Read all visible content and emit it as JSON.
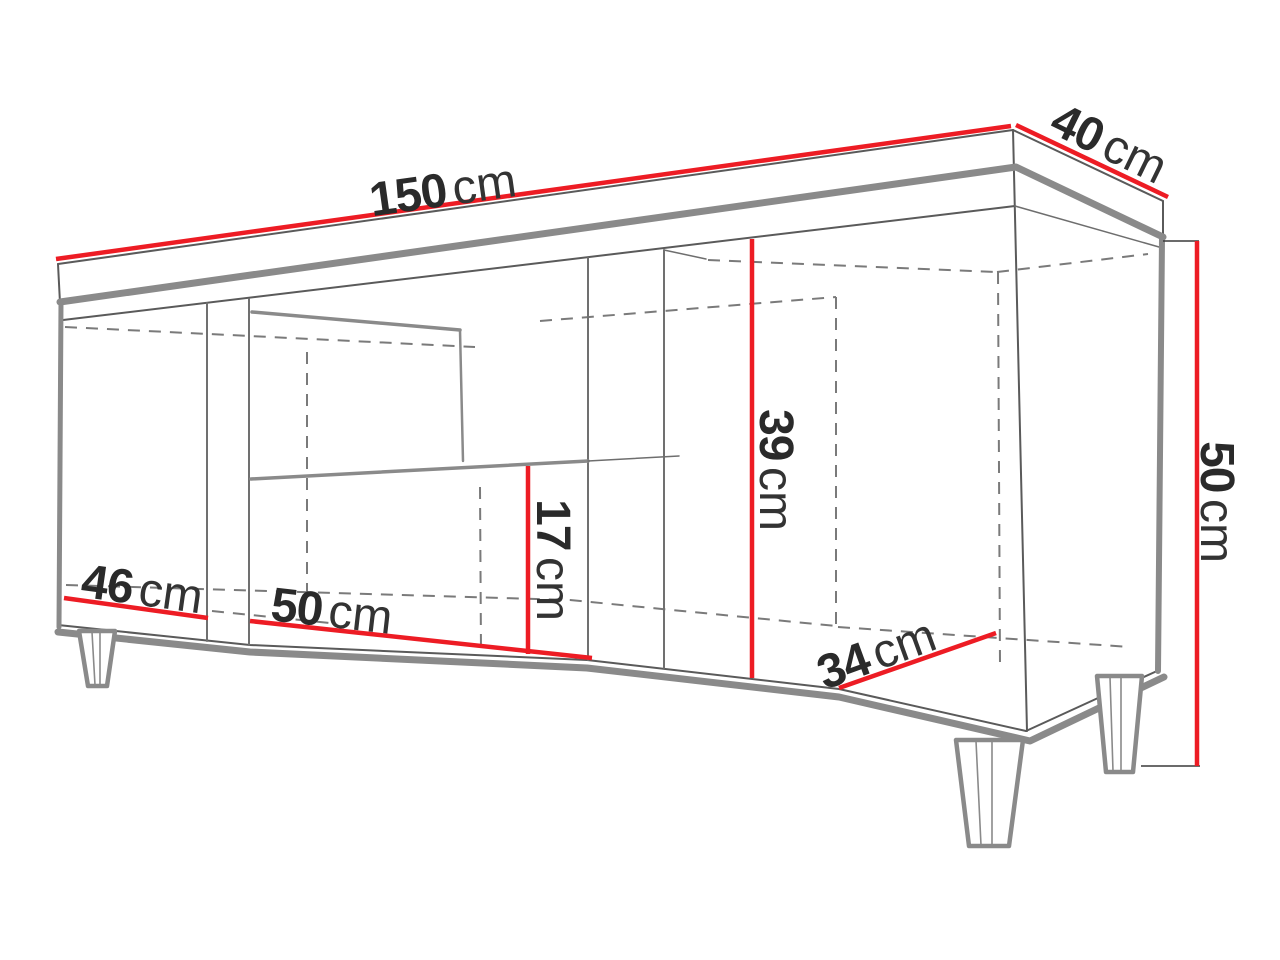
{
  "diagram": {
    "type": "furniture-dimension-diagram",
    "subject": "TV stand cabinet wireframe with tapered feet, open middle shelf niche and dimension callouts",
    "unit": "cm",
    "colors": {
      "dimension_line": "#ed1c24",
      "outline_thick": "#8a8a8a",
      "outline_thin": "#5a5a5a",
      "hidden_edge": "#7a7a7a",
      "label_text": "#2a2a2a",
      "background": "#ffffff"
    },
    "dimensions": [
      {
        "id": "top-width",
        "value": "150",
        "unit": "cm"
      },
      {
        "id": "top-depth",
        "value": "40",
        "unit": "cm"
      },
      {
        "id": "overall-height",
        "value": "50",
        "unit": "cm"
      },
      {
        "id": "right-interior-height",
        "value": "39",
        "unit": "cm"
      },
      {
        "id": "middle-lower-height",
        "value": "17",
        "unit": "cm"
      },
      {
        "id": "middle-width",
        "value": "50",
        "unit": "cm"
      },
      {
        "id": "left-width",
        "value": "46",
        "unit": "cm"
      },
      {
        "id": "interior-depth",
        "value": "34",
        "unit": "cm"
      }
    ]
  }
}
